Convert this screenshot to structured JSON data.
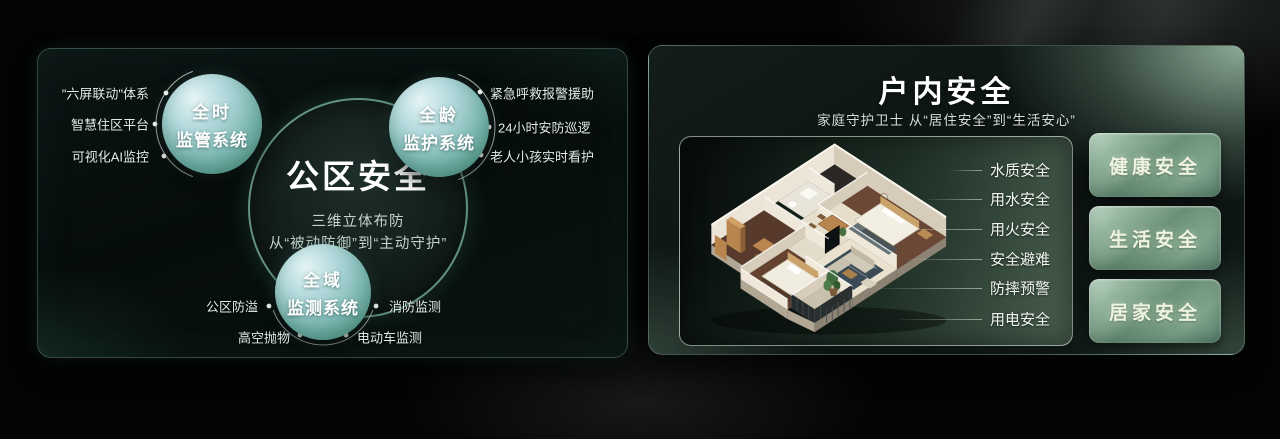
{
  "left_card": {
    "center": {
      "title": "公区安全",
      "desc1": "三维立体布防",
      "desc2": "从“被动防御”到“主动守护”"
    },
    "nodes": [
      {
        "line1": "全时",
        "line2": "监管系统"
      },
      {
        "line1": "全龄",
        "line2": "监护系统"
      },
      {
        "line1": "全域",
        "line2": "监测系统"
      }
    ],
    "left_labels": [
      "\"六屏联动\"体系",
      "智慧住区平台",
      "可视化AI监控"
    ],
    "right_labels": [
      "紧急呼救报警援助",
      "24小时安防巡逻",
      "老人小孩实时看护"
    ],
    "bottom_labels": [
      "公区防溢",
      "消防监测",
      "高空抛物",
      "电动车监测"
    ]
  },
  "right_card": {
    "title": "户内安全",
    "subtitle": "家庭守护卫士  从“居住安全”到“生活安心”",
    "floor_labels": [
      "水质安全",
      "用水安全",
      "用火安全",
      "安全避难",
      "防摔预警",
      "用电安全"
    ],
    "buttons": [
      "健康安全",
      "生活安全",
      "居家安全"
    ]
  },
  "colors": {
    "ring_teal": "#7db9a0",
    "node_gradient_start": "#e4f3f5",
    "node_gradient_end": "#4f8f81",
    "button_green": "#6c9179",
    "label_text": "#e2ebe6"
  }
}
